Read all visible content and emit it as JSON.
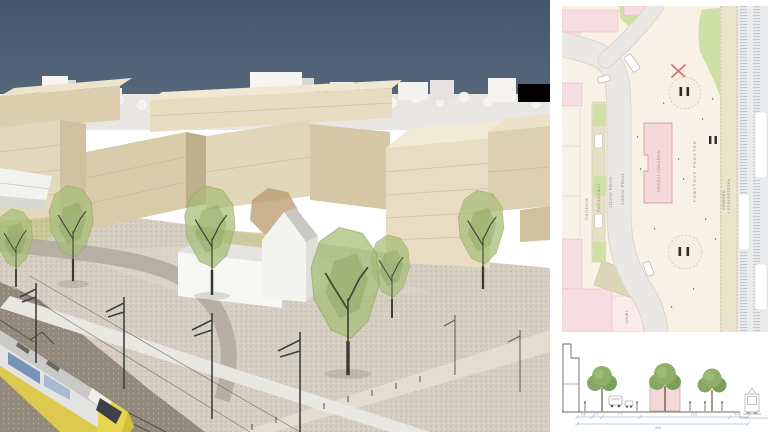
{
  "site_plan": {
    "labels": {
      "chodnik": "CHODNÍK",
      "parkovani": "PARKOVÁNÍ",
      "jizdni_pruh_1": "JÍZDNÍ PRUH",
      "jizdni_pruh_2": "JÍZDNÍ PRUH",
      "drazni_vodarna": "DRÁŽNÍ VODÁRNA",
      "pobytovy_prostor": "POBYTOVÝ PROSTOR",
      "path_line_1": "CHODNÍK",
      "path_line_2": "+ CYKLOSTEZKA",
      "loubi": "LOUBÍ"
    }
  },
  "section": {
    "dimensions": {
      "segments": [
        "3.5",
        "2.0",
        "7.0",
        "19.0",
        "5.0"
      ],
      "total": "36.5"
    }
  },
  "colors": {
    "sky_top": "#44546a",
    "sky_bottom": "#5c6c7f",
    "context_white": "#f2f1ee",
    "massing_tan": "#e5dabe",
    "massing_shade": "#c8b795",
    "tree_green": "#a6bd76",
    "ground_gravel": "#d5cfc1",
    "road_gray": "#b2ab9e",
    "ballast_brown": "#93897a",
    "train_yellow": "#e8d64f",
    "plan_background": "#f8f1e6",
    "plan_pink": "#f6dde1",
    "plan_green": "#cfe0a5",
    "plan_road": "#e9e8e4",
    "rail_corridor": "#e9ebed",
    "dimension_blue": "#7d9cc0",
    "section_house_pink": "#f2d8d8",
    "marker_red": "#e06e6e"
  }
}
